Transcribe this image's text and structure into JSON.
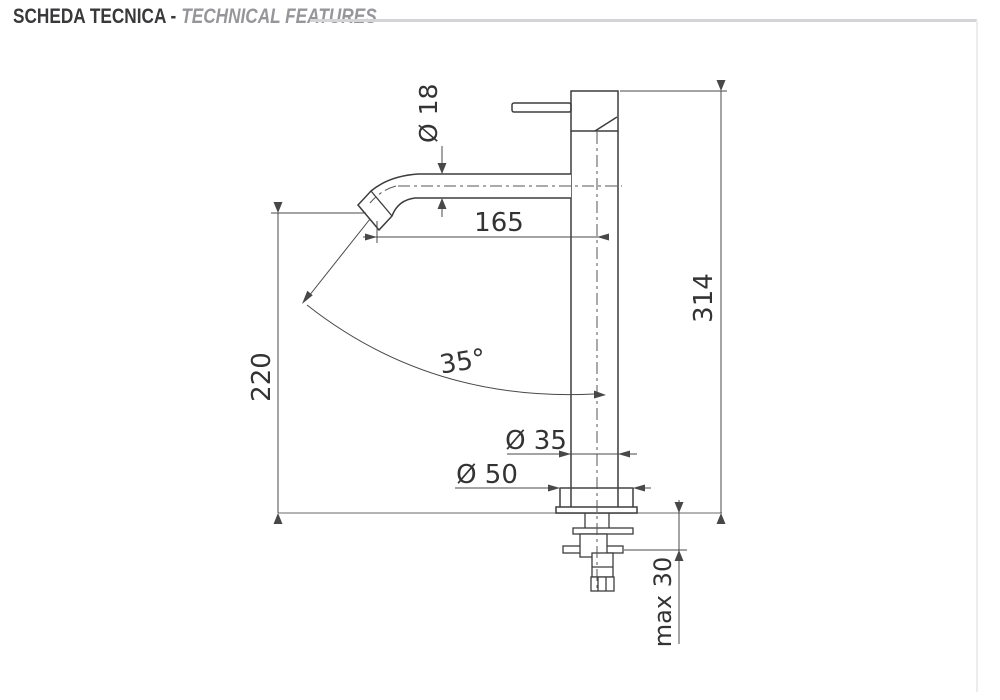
{
  "header": {
    "title_primary": "SCHEDA TECNICA -",
    "title_secondary": "TECHNICAL FEATURES"
  },
  "drawing": {
    "labels": {
      "spout_diameter": "Ø 18",
      "spout_reach": "165",
      "total_height": "314",
      "spout_height": "220",
      "spout_angle": "35°",
      "body_diameter": "Ø 35",
      "base_diameter": "Ø 50",
      "max_deck_thickness": "max 30"
    },
    "colors": {
      "outline": "#3d3d3f",
      "dimension": "#48484a",
      "centerline": "#545456",
      "counter_line": "#9b9b9e",
      "title_primary": "#39393b",
      "title_secondary": "#96969a",
      "header_rule": "#d4d4d7"
    }
  }
}
